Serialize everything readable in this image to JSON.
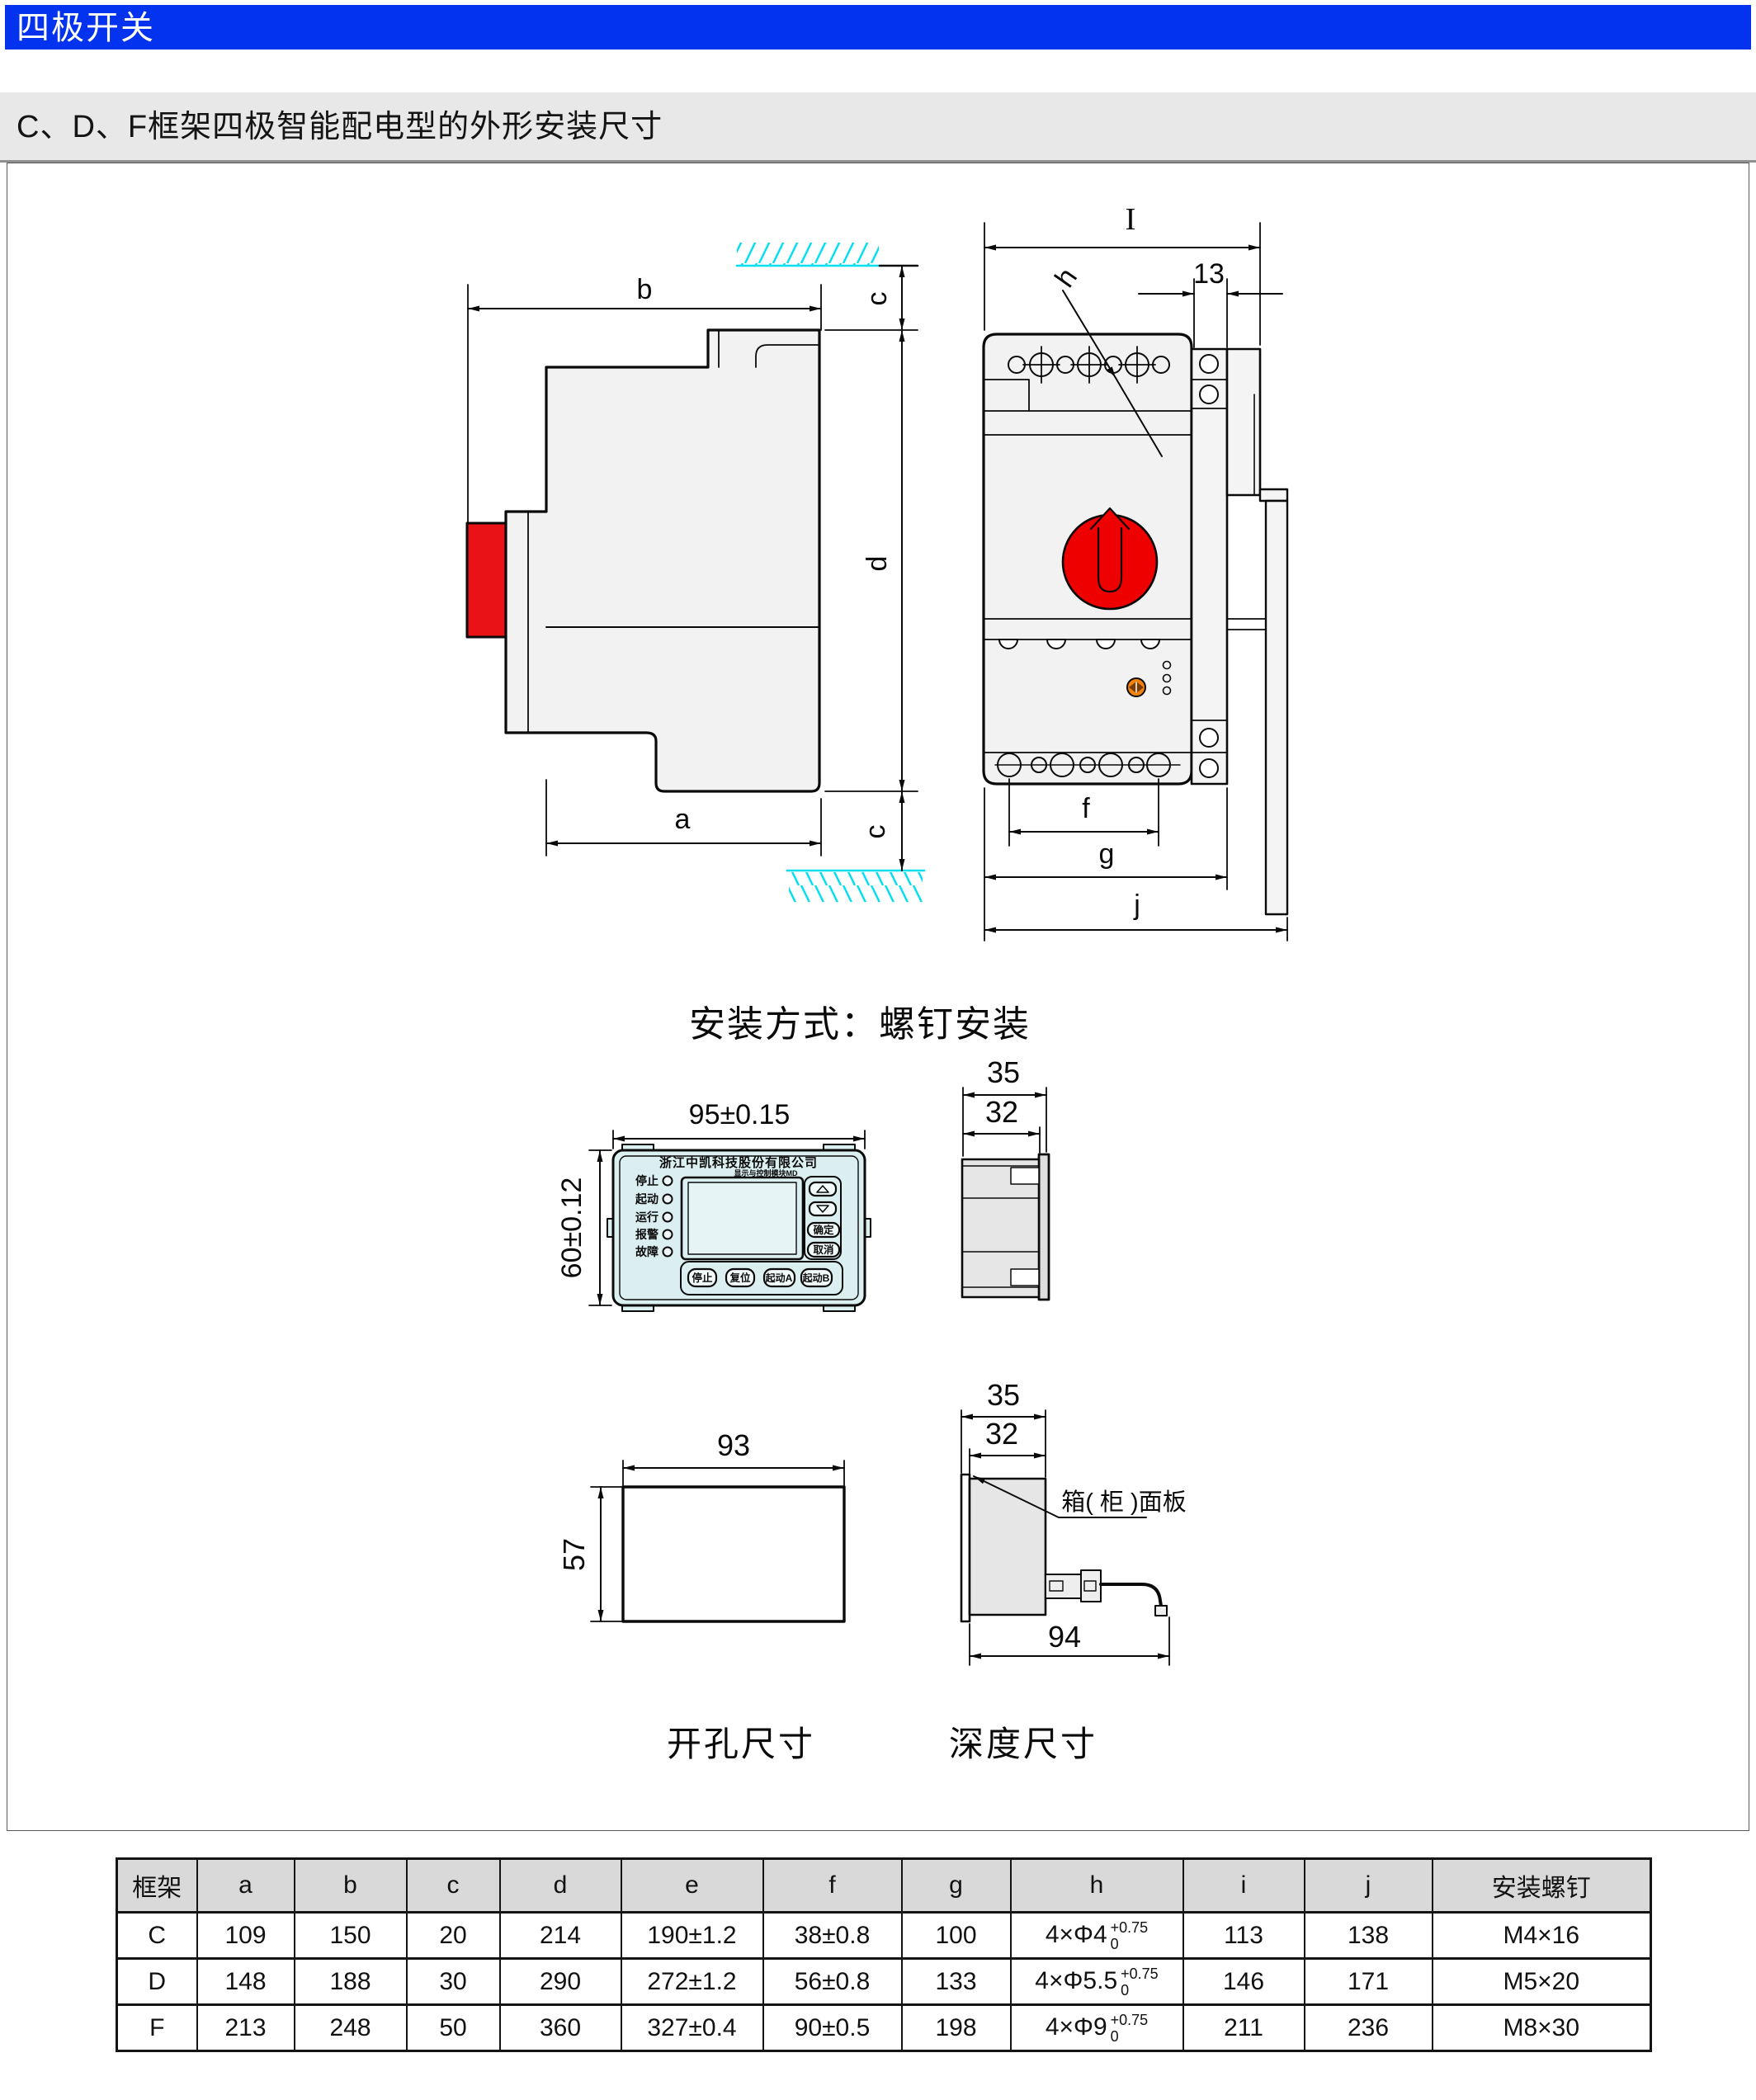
{
  "page": {
    "title": "四极开关",
    "section_heading": "C、D、F框架四极智能配电型的外形安装尺寸",
    "mounting_note": "安装方式：螺钉安装",
    "cutout_label": "开孔尺寸",
    "depth_label": "深度尺寸"
  },
  "colors": {
    "banner_blue": "#0433f0",
    "band_gray": "#e8e8e8",
    "handle_red": "#e81217",
    "knob_red": "#ee0000",
    "hatch_cyan": "#00dff2",
    "screw_orange": "#f5820a",
    "panel_cyan": "#dbeef0"
  },
  "side_view": {
    "dim_b": "b",
    "dim_c": "c",
    "dim_d": "d",
    "dim_a": "a"
  },
  "front_view": {
    "dim_I": "I",
    "dim_13": "13",
    "dim_h": "h",
    "dim_f": "f",
    "dim_g": "g",
    "dim_j": "j"
  },
  "panel": {
    "company": "浙江中凯科技股份有限公司",
    "module": "显示与控制模块MD",
    "leds": [
      "停止",
      "起动",
      "运行",
      "报警",
      "故障"
    ],
    "buttons": {
      "ok": "确定",
      "cancel": "取消",
      "stop": "停止",
      "reset": "复位",
      "startA": "起动A",
      "startB": "起动B"
    },
    "dim_width": "95±0.15",
    "dim_height": "60±0.12"
  },
  "panel_side": {
    "dim_total": "35",
    "dim_body": "32"
  },
  "cutout": {
    "dim_width": "93",
    "dim_height": "57"
  },
  "depth": {
    "dim_total": "35",
    "dim_body": "32",
    "dim_depth": "94",
    "callout": "箱( 柜 )面板"
  },
  "table": {
    "headers": [
      "框架",
      "a",
      "b",
      "c",
      "d",
      "e",
      "f",
      "g",
      "h",
      "i",
      "j",
      "安装螺钉"
    ],
    "rows": [
      {
        "frame": "C",
        "a": "109",
        "b": "150",
        "c": "20",
        "d": "214",
        "e": "190±1.2",
        "f": "38±0.8",
        "g": "100",
        "h_base": "4×Φ4",
        "h_sup": "+0.75",
        "h_sub": "0",
        "i": "113",
        "j": "138",
        "screw": "M4×16"
      },
      {
        "frame": "D",
        "a": "148",
        "b": "188",
        "c": "30",
        "d": "290",
        "e": "272±1.2",
        "f": "56±0.8",
        "g": "133",
        "h_base": "4×Φ5.5",
        "h_sup": "+0.75",
        "h_sub": "0",
        "i": "146",
        "j": "171",
        "screw": "M5×20"
      },
      {
        "frame": "F",
        "a": "213",
        "b": "248",
        "c": "50",
        "d": "360",
        "e": "327±0.4",
        "f": "90±0.5",
        "g": "198",
        "h_base": "4×Φ9",
        "h_sup": "+0.75",
        "h_sub": "0",
        "i": "211",
        "j": "236",
        "screw": "M8×30"
      }
    ]
  }
}
